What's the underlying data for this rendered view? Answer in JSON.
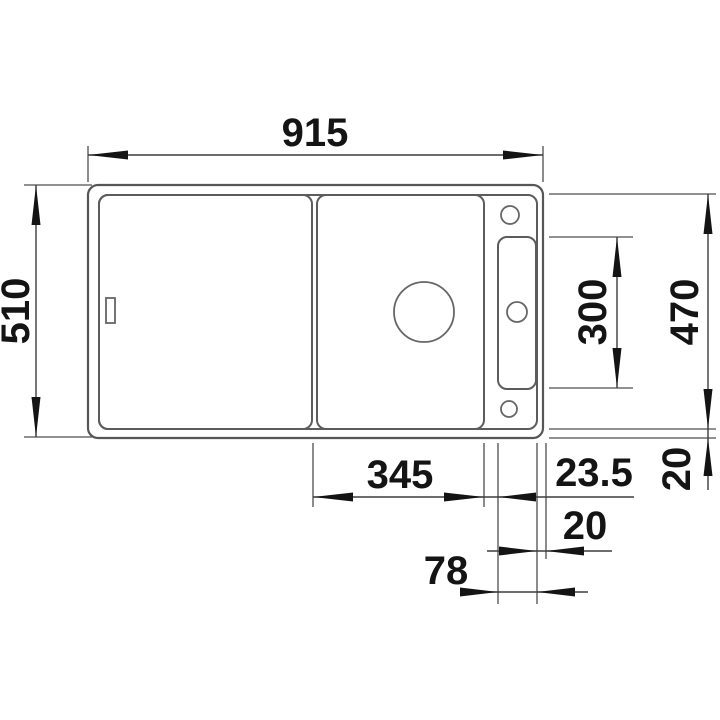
{
  "drawing": {
    "kind": "sink top-view technical dimension drawing",
    "units_shown": "mm (implied, unlabeled)",
    "dimensions": {
      "overall_width": "915",
      "overall_depth": "510",
      "inner_depth": "470",
      "tray_length": "300",
      "bowl_width": "345",
      "bowl_to_tray_offset": "23.5",
      "tray_width": "78",
      "tray_to_edge": "20",
      "rim_bottom": "20"
    },
    "features": [
      "outer-sink-edge",
      "inner-rim-edge",
      "drainboard-area",
      "main-bowl",
      "drain-hole",
      "overflow-mark",
      "accessory-tray-recess",
      "tap-hole-top",
      "tap-hole-middle",
      "tap-hole-bottom"
    ],
    "colors": {
      "background": "#ffffff",
      "sink_outline": "#5c5c5c",
      "dimension_lines": "#3d3d3d",
      "text": "#141414"
    }
  }
}
